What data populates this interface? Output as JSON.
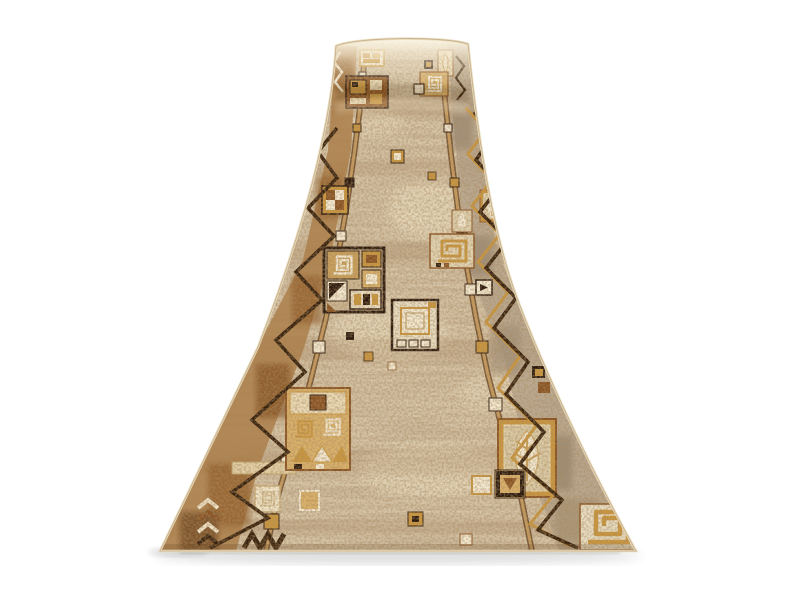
{
  "meta": {
    "domain": "product-photo",
    "subject": "Beige-brown patterned carpet runner shown in perspective, far end rolled over, on white background",
    "background_color": "#ffffff"
  },
  "colors": {
    "base": "#d7c6a9",
    "field_light": "#e9dcc0",
    "streak_brown": "#8a6a48",
    "speckle_brown": "#6b4a26",
    "border_left": "#a9773f",
    "border_left_dark": "#8a5424",
    "border_right": "#b3a189",
    "accent_gold": "#c9963f",
    "tan": "#d8b06a",
    "cream": "#f2e8d0",
    "outline_dark": "#2e1c10",
    "zigzag_dark": "#3a2410",
    "selvedge": "#e8dabb"
  },
  "motifs": {
    "far_end": "rolled-over end with bright highlight",
    "left_border": "dark zigzag line over rich brown mottle",
    "right_border": "gold and dark zigzag lines over taupe mottle",
    "field": "speckled beige field with two bead rails, framed squares, spirals, leaf tiles and checker triangles"
  }
}
